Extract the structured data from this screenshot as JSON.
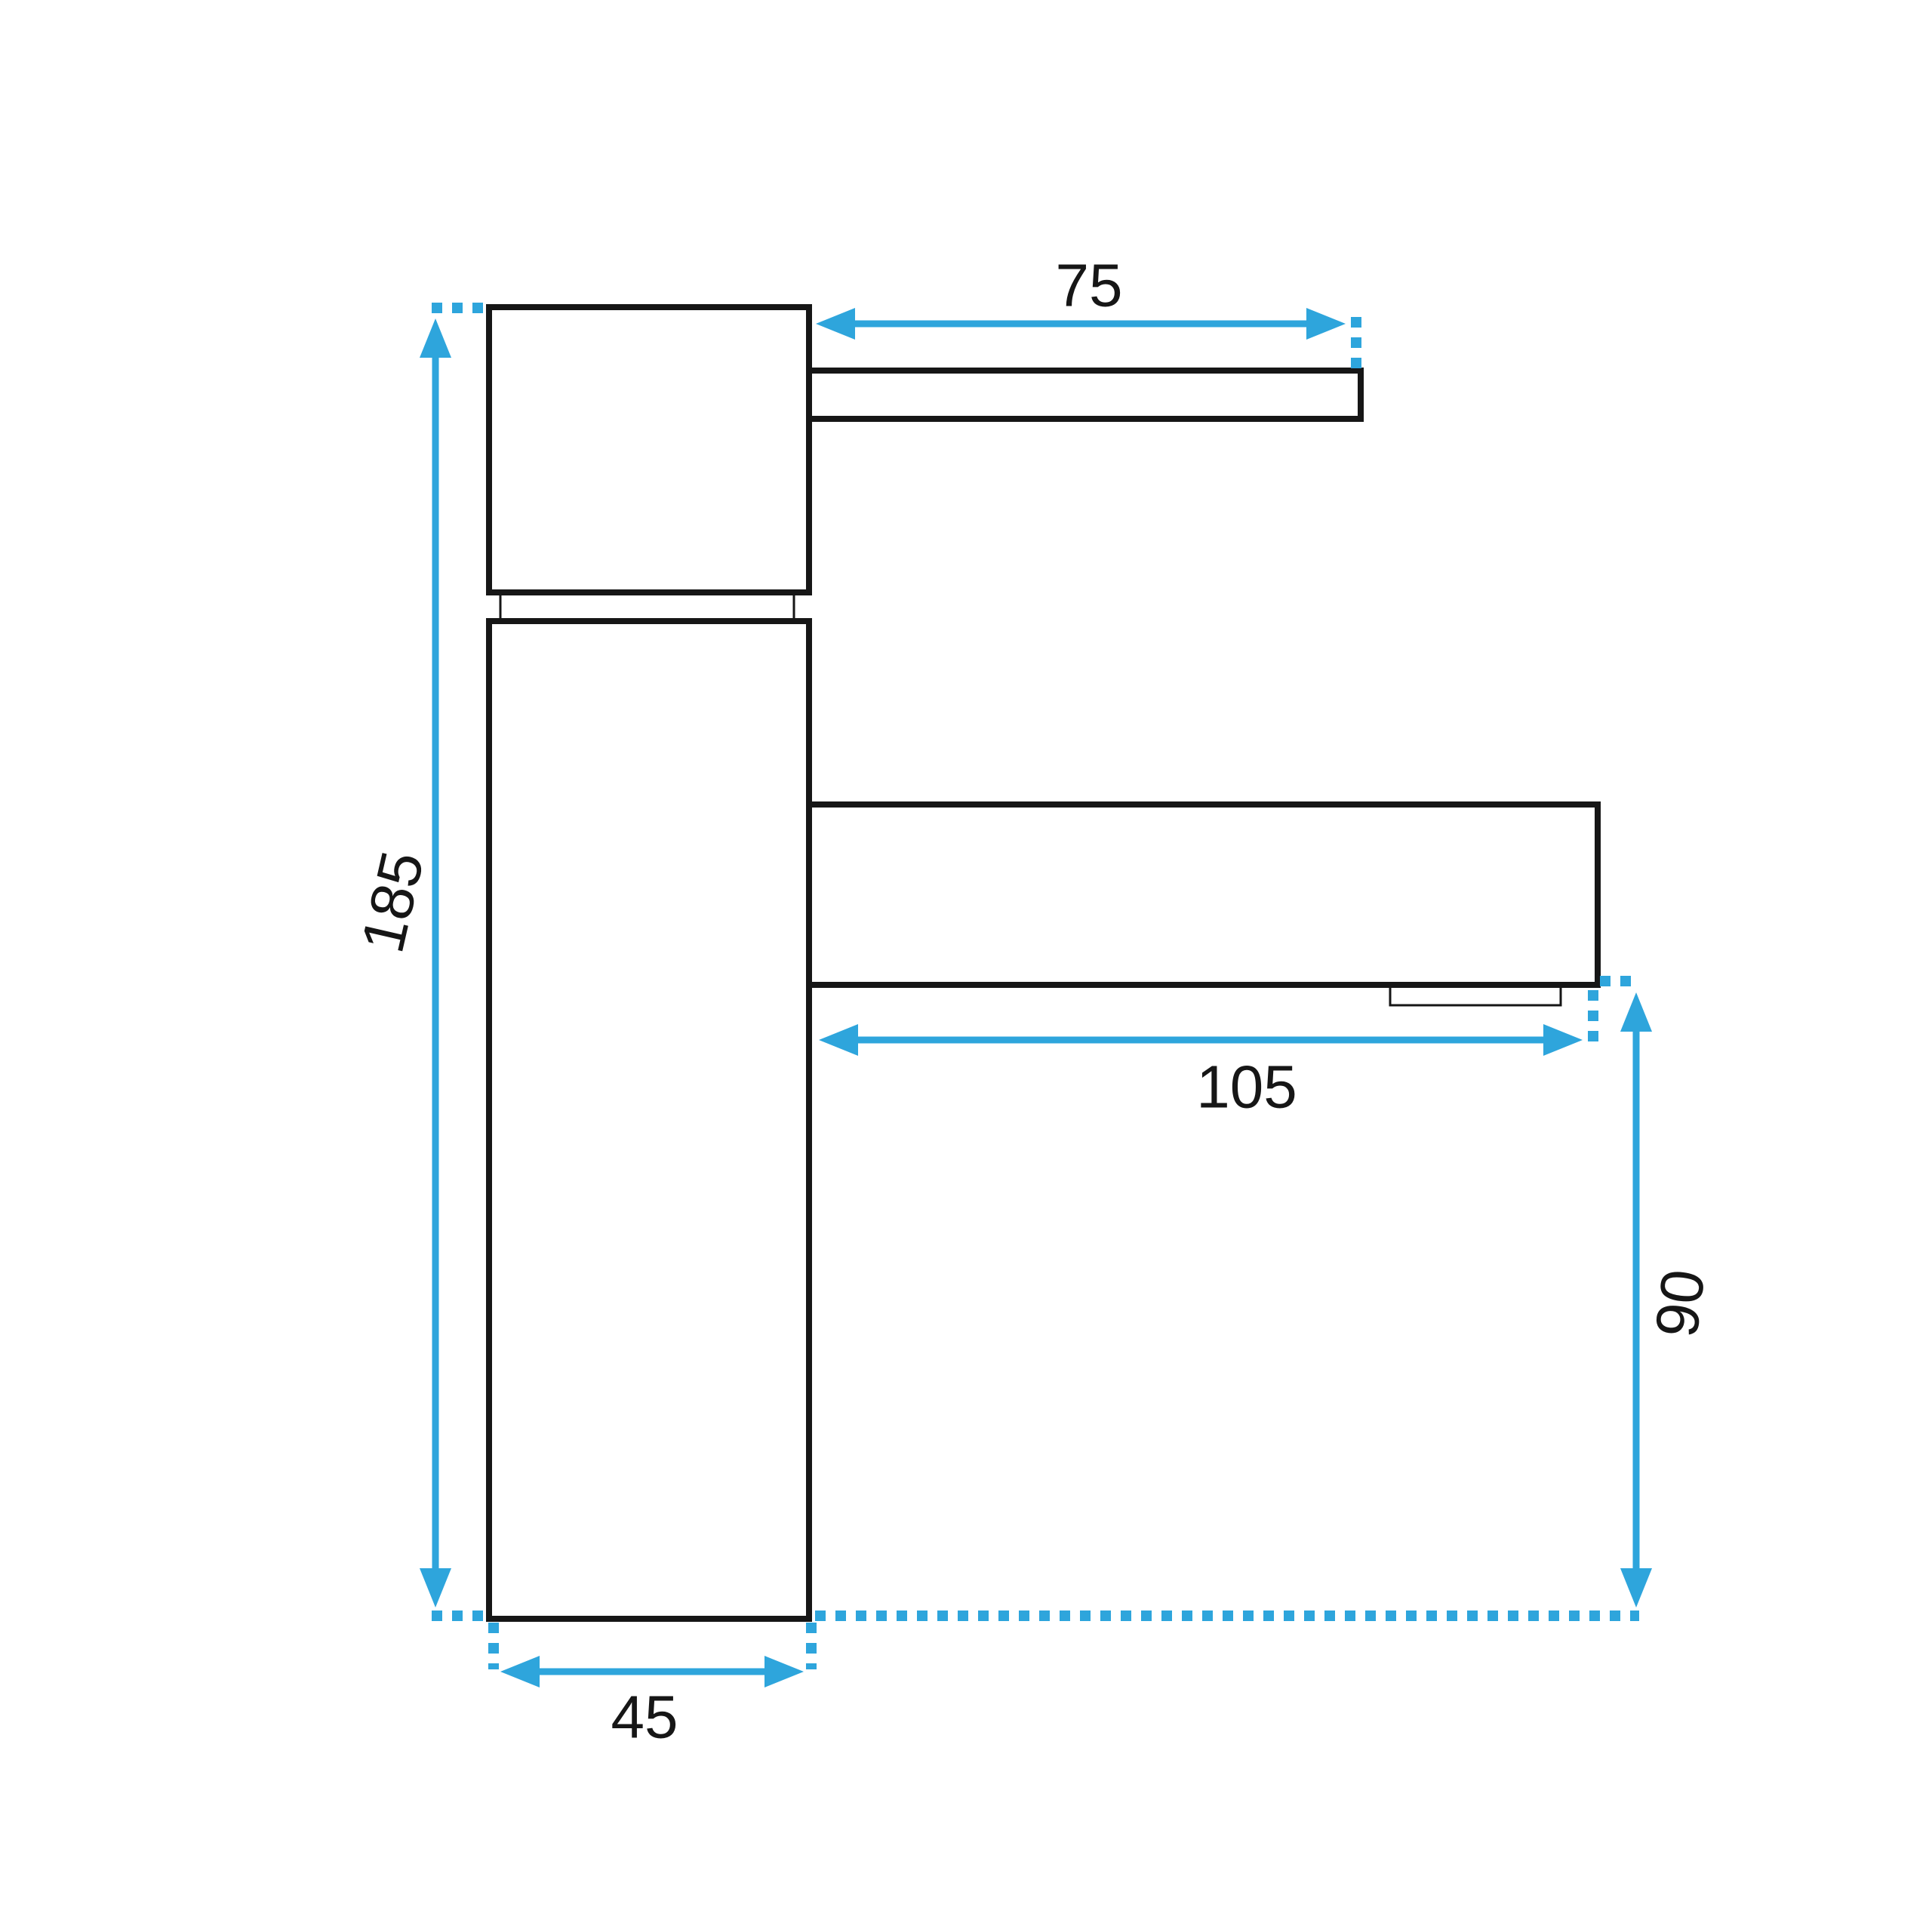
{
  "diagram": {
    "type": "technical-dimension-drawing",
    "subject": "single-lever basin faucet, side elevation view",
    "dimensions": {
      "lever_length": {
        "value": "75"
      },
      "overall_height": {
        "value": "185"
      },
      "spout_reach": {
        "value": "105"
      },
      "outlet_height": {
        "value": "90"
      },
      "base_depth": {
        "value": "45"
      }
    },
    "colors": {
      "dimension_lines": "#2EA5DC",
      "outlines": "#161616",
      "background": "#FFFFFF"
    }
  }
}
